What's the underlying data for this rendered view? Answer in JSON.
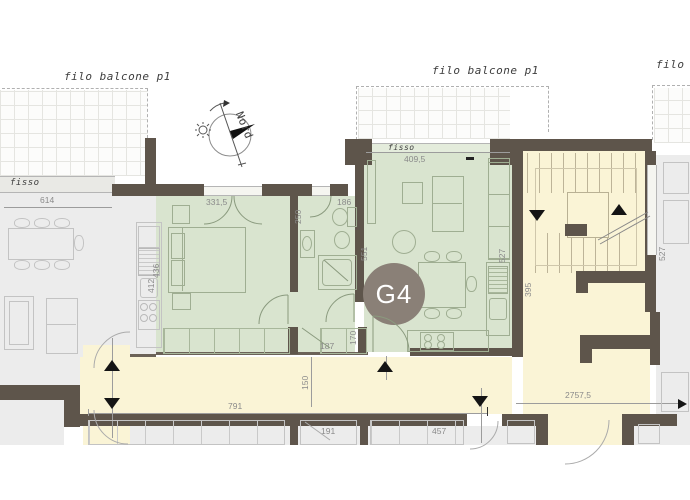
{
  "unit_badge": {
    "label": "G4"
  },
  "compass": {
    "label": "Nord"
  },
  "annotations": {
    "balcony_line_labels": [
      "filo balcone p1",
      "filo balcone p1",
      "filo balcone p1"
    ],
    "fixed_window_left": "fisso",
    "fixed_window_living": "fisso"
  },
  "dimensions": {
    "left_apartment_width": "614",
    "bedroom_width": "331,5",
    "bedroom_depth": "436",
    "bath_width": "186",
    "bath_depth": "250",
    "bath_side": "551",
    "left_kitchen_run": "412",
    "living_width": "409,5",
    "living_depth": "527",
    "stair_depth": "395",
    "stair_side": "527",
    "closet_depth": "170",
    "entry_width": "187",
    "corridor_width": "150",
    "corridor_length": "791",
    "corridor_total_length": "2757,5",
    "bottom_room_a": "191",
    "bottom_room_b": "457"
  },
  "colors": {
    "wall": "#5e554b",
    "unit": "#d9e4cf",
    "common": "#faf4d6",
    "neighbor": "#ececec",
    "badge": "#8a8077",
    "dash": "#b0b0b0",
    "dimtext": "#8a8a8a"
  }
}
